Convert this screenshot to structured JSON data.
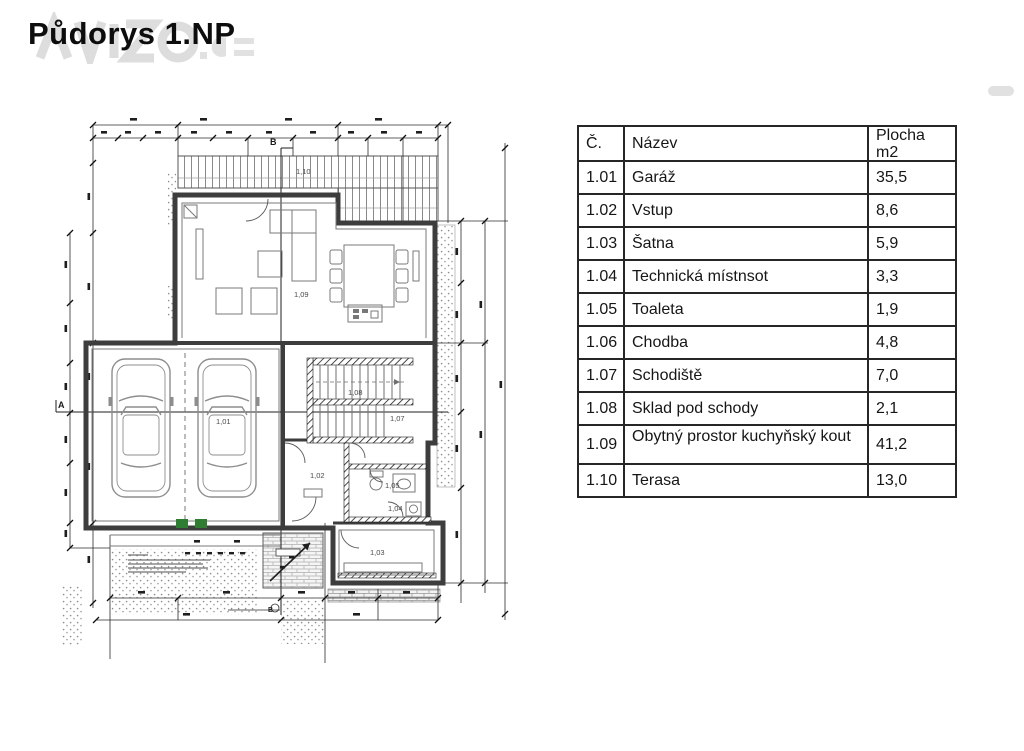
{
  "title": "Půdorys 1.NP",
  "table": {
    "headers": {
      "num": "Č.",
      "name": "Název",
      "area_line1": "Plocha",
      "area_line2": "m2"
    },
    "rows": [
      {
        "num": "1.01",
        "name": "Garáž",
        "area": "35,5"
      },
      {
        "num": "1.02",
        "name": "Vstup",
        "area": "8,6"
      },
      {
        "num": "1.03",
        "name": "Šatna",
        "area": "5,9"
      },
      {
        "num": "1.04",
        "name": "Technická místnsot",
        "area": "3,3"
      },
      {
        "num": "1.05",
        "name": "Toaleta",
        "area": "1,9"
      },
      {
        "num": "1.06",
        "name": "Chodba",
        "area": "4,8"
      },
      {
        "num": "1.07",
        "name": "Schodiště",
        "area": "7,0"
      },
      {
        "num": "1.08",
        "name": "Sklad pod schody",
        "area": "2,1"
      },
      {
        "num": "1.09",
        "name": "Obytný prostor kuchyňský kout",
        "area": "41,2"
      },
      {
        "num": "1.10",
        "name": "Terasa",
        "area": "13,0"
      }
    ]
  },
  "plan": {
    "room_labels": [
      {
        "text": "1,10"
      },
      {
        "text": "1,09"
      },
      {
        "text": "1,01"
      },
      {
        "text": "1,08"
      },
      {
        "text": "1,07"
      },
      {
        "text": "1,02"
      },
      {
        "text": "1,05"
      },
      {
        "text": "1,04"
      },
      {
        "text": "1,03"
      }
    ],
    "marker_a": "A",
    "marker_b": "B"
  },
  "colors": {
    "door_accent": "#2f7d32",
    "line": "#3d3d3d"
  }
}
